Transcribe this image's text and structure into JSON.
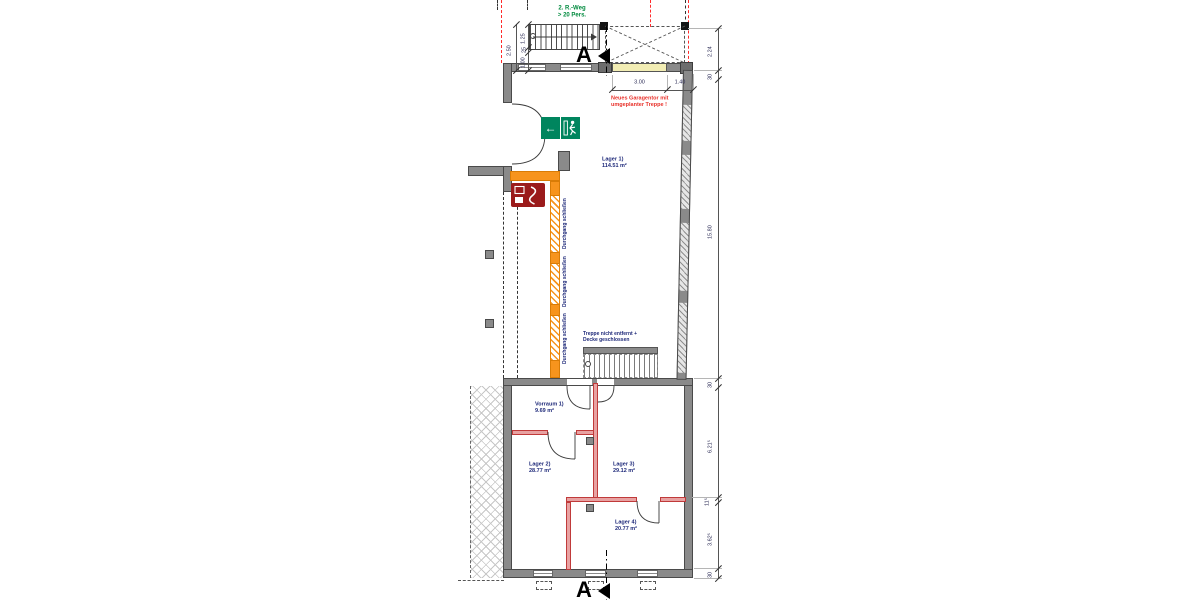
{
  "colors": {
    "existing_wall_gray": "#8a8a8a",
    "new_wall_red_border": "#c03a3a",
    "new_wall_red_fill": "#e8a2a2",
    "close_wall_orange": "#f7941d",
    "demolition_dashed_red": "#ff2a2a",
    "garage_lintel_yellow": "#f2edb4",
    "exit_sign_green": "#00855e",
    "note_red": "#e8312a",
    "room_label_navy": "#1f2a7a",
    "hydrant_sign_red": "#9b1b1b"
  },
  "notes": {
    "escape_route_line1": "2. R.-Weg",
    "escape_route_line2": "> 20 Pers.",
    "garage_line1": "Neues Garagentor mit",
    "garage_line2": "umgeplanter Treppe !",
    "stair_line1": "Treppe nicht entfernt +",
    "stair_line2": "Decke geschlossen",
    "close_passage": "Durchgang schließen"
  },
  "rooms": [
    {
      "name": "Lager 1)",
      "area": "114.51 m²"
    },
    {
      "name": "Vorraum 1)",
      "area": "9.69 m²"
    },
    {
      "name": "Lager 2)",
      "area": "28.77 m²"
    },
    {
      "name": "Lager 3)",
      "area": "29.12 m²"
    },
    {
      "name": "Lager 4)",
      "area": "20.77 m²"
    }
  ],
  "dimensions": {
    "left_total": "2.50",
    "stair_chain": [
      "1.25",
      "25",
      "1.00"
    ],
    "garage_chain": [
      "3.00",
      "1.40"
    ],
    "right_chain": [
      "2.24",
      "30",
      "15.80",
      "30",
      "6.21⁵",
      "11⁵",
      "3.62⁵",
      "30"
    ]
  },
  "section": {
    "label": "A"
  },
  "icons": {
    "exit_arrow": "←"
  }
}
